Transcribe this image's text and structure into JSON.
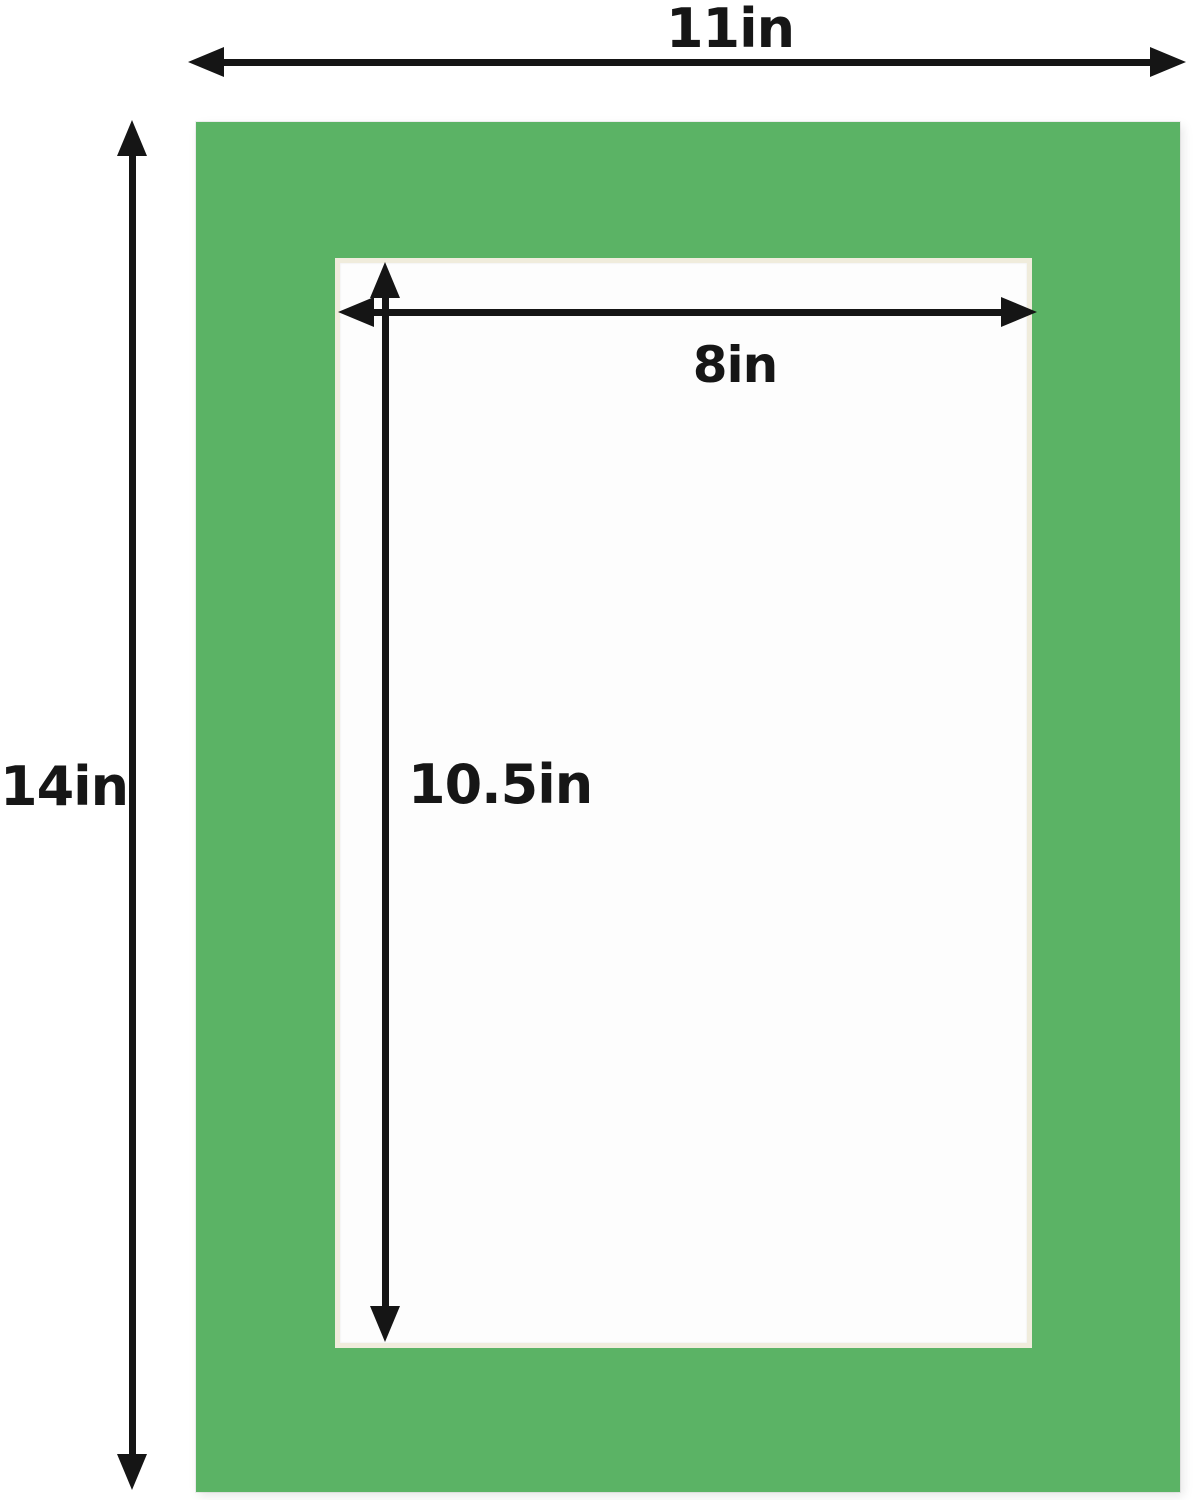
{
  "diagram": {
    "description": "Green picture frame mat board dimension diagram",
    "outer_width_label": "11in",
    "outer_height_label": "14in",
    "opening_width_label": "8in",
    "opening_height_label": "10.5in",
    "outer_width_in": 11,
    "outer_height_in": 14,
    "opening_width_in": 8,
    "opening_height_in": 10.5
  },
  "colors": {
    "mat_green": "#5bb365",
    "opening_white": "#fdfdfd",
    "bevel_cream": "#f0ecdc",
    "arrow_black": "#151515"
  }
}
